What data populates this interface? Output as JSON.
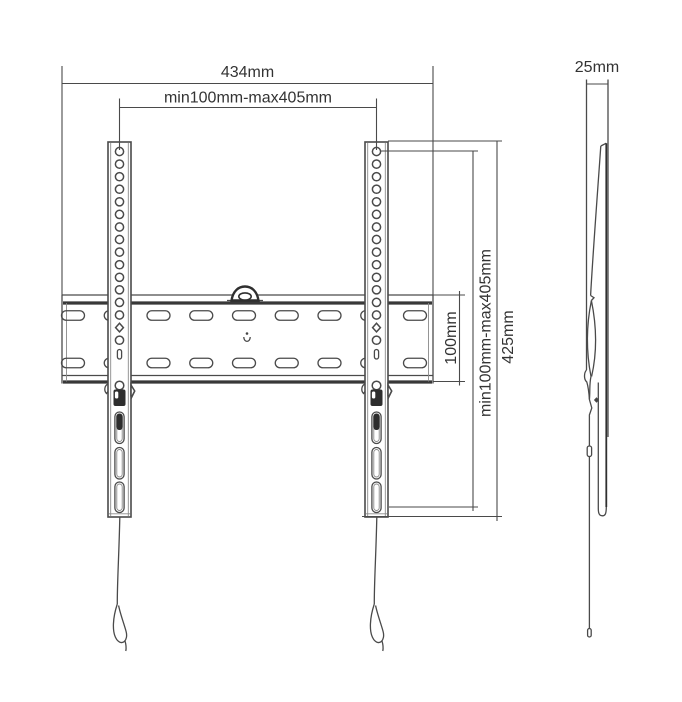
{
  "drawing": {
    "type": "technical-dimension-drawing",
    "subject": "TV wall mount bracket",
    "views": {
      "front": {
        "name": "front view",
        "dimensions": [
          {
            "id": "total-width",
            "label": "434mm",
            "orientation": "horizontal"
          },
          {
            "id": "vesa-width-range",
            "label": "min100mm-max405mm",
            "orientation": "horizontal"
          },
          {
            "id": "plate-height",
            "label": "100mm",
            "orientation": "vertical"
          },
          {
            "id": "vesa-height-range",
            "label": "min100mm-max405mm",
            "orientation": "vertical"
          },
          {
            "id": "total-height",
            "label": "425mm",
            "orientation": "vertical"
          }
        ]
      },
      "side": {
        "name": "side view",
        "dimensions": [
          {
            "id": "depth",
            "label": "25mm",
            "orientation": "horizontal"
          }
        ]
      }
    },
    "colors": {
      "line": "#4a4a4a",
      "line_dark": "#303030",
      "text": "#333333",
      "background": "#ffffff"
    }
  }
}
